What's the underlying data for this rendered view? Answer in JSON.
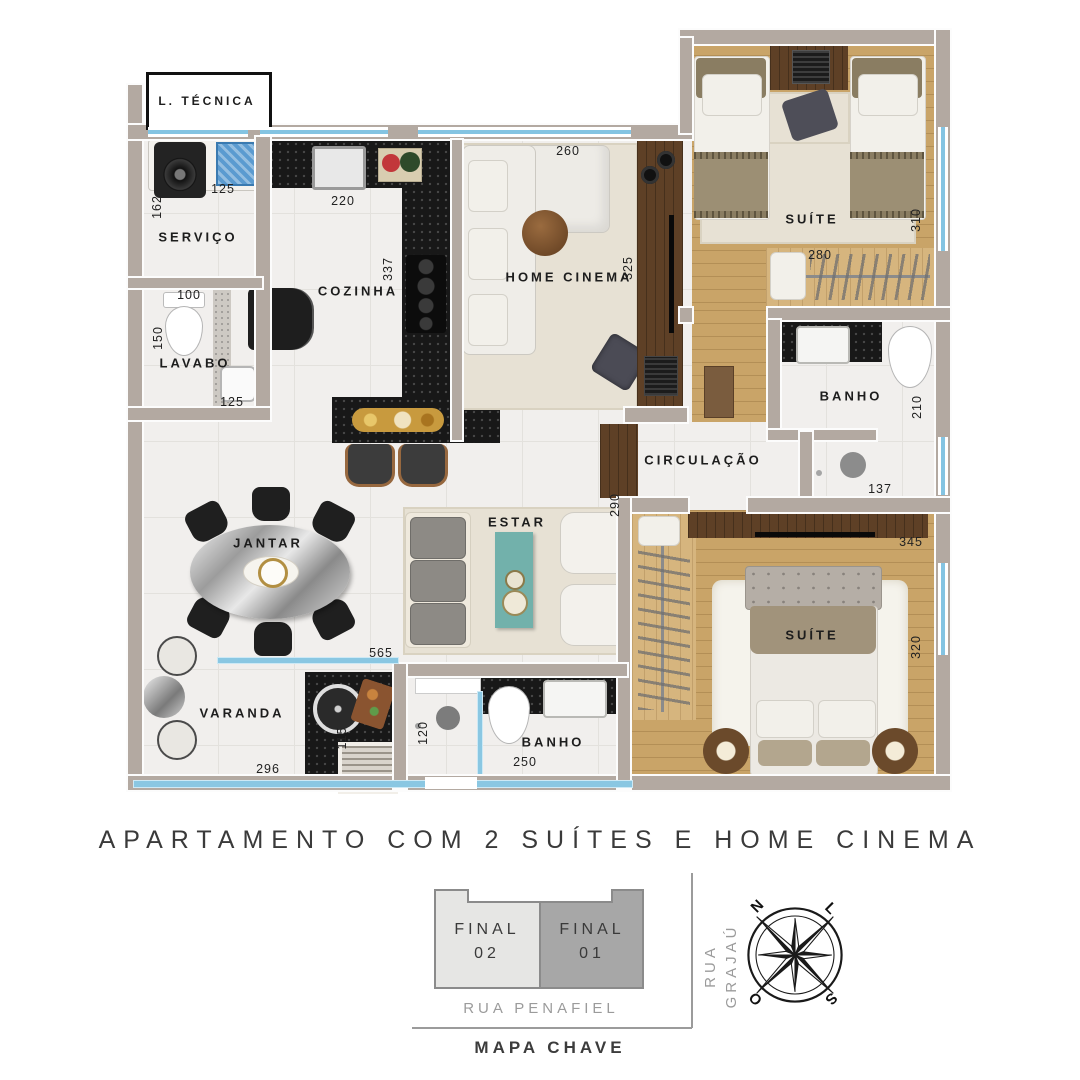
{
  "title": "APARTAMENTO COM 2 SUÍTES E HOME CINEMA",
  "rooms": {
    "l_tecnica": "L. TÉCNICA",
    "servico": "SERVIÇO",
    "cozinha": "COZINHA",
    "lavabo": "LAVABO",
    "home_cinema": "HOME CINEMA",
    "suite1": "SUÍTE",
    "banho1": "BANHO",
    "circulacao": "CIRCULAÇÃO",
    "jantar": "JANTAR",
    "estar": "ESTAR",
    "suite2": "SUÍTE",
    "banho2": "BANHO",
    "varanda": "VARANDA"
  },
  "dims": {
    "servico_tanque": "125",
    "servico_left": "162",
    "cozinha_top": "220",
    "cozinha_side": "337",
    "lavabo_top": "100",
    "lavabo_left": "150",
    "lavabo_bottom": "125",
    "home_cinema_top": "260",
    "home_cinema_side": "325",
    "suite1_side": "310",
    "suite1_width": "280",
    "banho1_side": "210",
    "shower1_width": "137",
    "estar_side": "290",
    "suite2_top": "345",
    "suite2_side": "320",
    "estar_bottom": "565",
    "varanda_counter": "115",
    "varanda_bottom": "296",
    "banho2_left": "120",
    "banho2_bottom": "250"
  },
  "key_map": {
    "unit_left": "FINAL\n02",
    "unit_right": "FINAL\n01",
    "street_right": "RUA GRAJAÚ",
    "street_bottom": "RUA PENAFIEL",
    "caption": "MAPA CHAVE"
  },
  "compass": {
    "n": "N",
    "l": "L",
    "o": "O",
    "s": "S"
  },
  "colors": {
    "wall": "#b3a9a1",
    "tile": "#f1efed",
    "wood": "#c9a468",
    "counter": "#181818",
    "glass": "#84c4e2",
    "rug": "#e7e1d4",
    "teal": "#72b1ab"
  }
}
